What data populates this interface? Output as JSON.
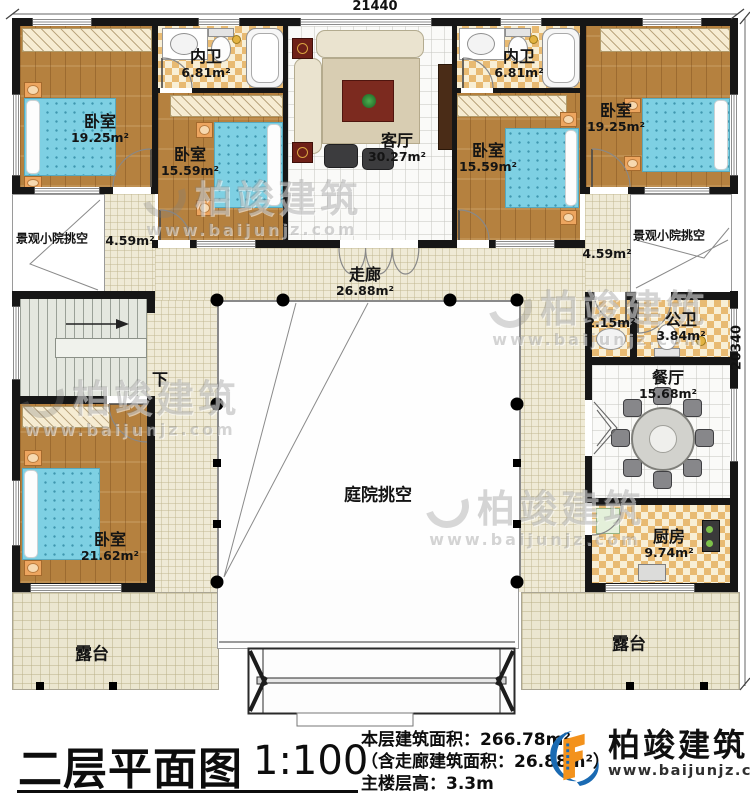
{
  "plan": {
    "dimensions": {
      "top": "21440",
      "right": "20340"
    },
    "watermark": {
      "brand": "柏竣建筑",
      "url": "www.baijunjz.com"
    },
    "rooms": {
      "bedroom_top_left": {
        "label": "卧室",
        "area": "19.25m²"
      },
      "inner_bath_left": {
        "label": "内卫",
        "area": "6.81m²"
      },
      "bedroom_mid_left": {
        "label": "卧室",
        "area": "15.59m²"
      },
      "living_room": {
        "label": "客厅",
        "area": "30.27m²"
      },
      "inner_bath_right": {
        "label": "内卫",
        "area": "6.81m²"
      },
      "bedroom_top_right": {
        "label": "卧室",
        "area": "19.25m²"
      },
      "bedroom_mid_right": {
        "label": "卧室",
        "area": "15.59m²"
      },
      "scenic_void_left": {
        "label": "景观小院挑空",
        "area": "4.59m²"
      },
      "scenic_void_right": {
        "label": "景观小院挑空",
        "area": "4.59m²"
      },
      "corridor": {
        "label": "走廊",
        "area": "26.88m²"
      },
      "stairs": {
        "label": "下"
      },
      "courtyard_void": {
        "label": "庭院挑空"
      },
      "bedroom_bottom_left": {
        "label": "卧室",
        "area": "21.62m²"
      },
      "wash_nook": {
        "area": "2.15m²"
      },
      "public_bath": {
        "label": "公卫",
        "area": "3.84m²"
      },
      "dining_room": {
        "label": "餐厅",
        "area": "15.68m²"
      },
      "kitchen": {
        "label": "厨房",
        "area": "9.74m²"
      },
      "terrace_left": {
        "label": "露台"
      },
      "terrace_right": {
        "label": "露台"
      }
    }
  },
  "title_block": {
    "title": "二层平面图",
    "scale": "1:100",
    "info_lines": [
      "本层建筑面积：266.78m²",
      "（含走廊建筑面积：26.88m²）",
      "主楼层高：3.3m"
    ]
  },
  "logo": {
    "brand": "柏竣建筑",
    "url": "www.baijunjz.com"
  },
  "colors": {
    "wall": "#161616",
    "wood_floor": "#b5813f",
    "tile": "#e8ba72",
    "bed": "#7ed0e3",
    "logo_blue": "#1a6ab2",
    "logo_orange": "#f3921c"
  }
}
